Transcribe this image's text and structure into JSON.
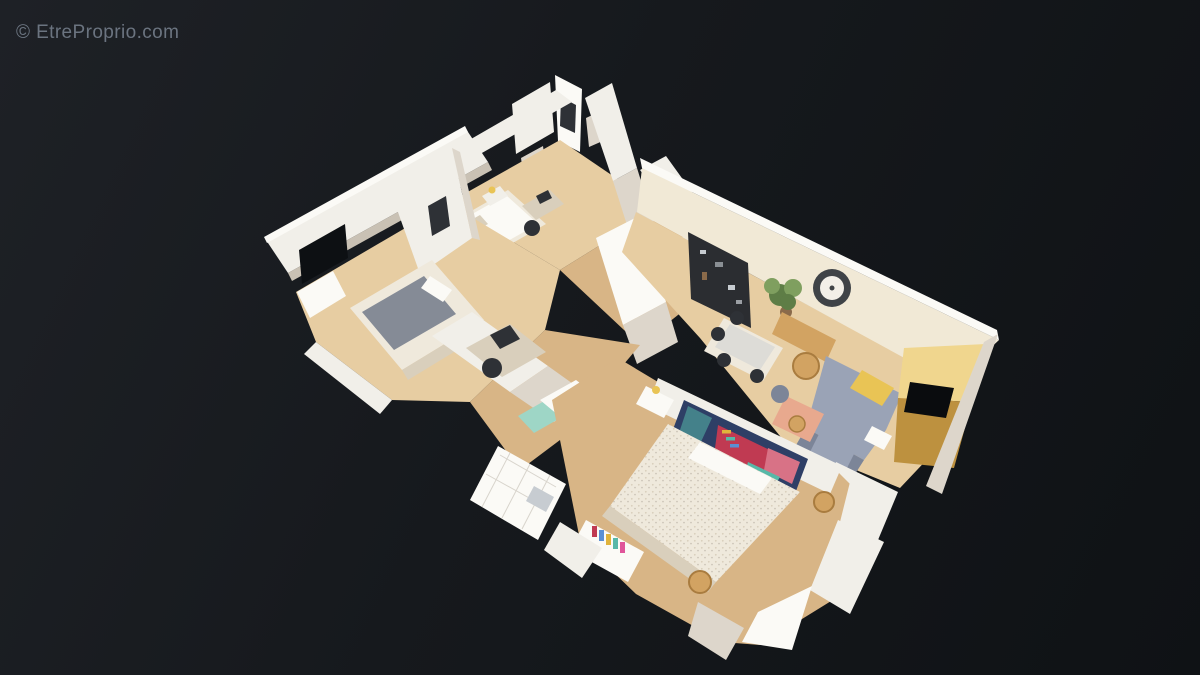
{
  "watermark": {
    "text": "© EtreProprio.com"
  },
  "scene": {
    "type": "3d-dollhouse-apartment-scan",
    "description": "Overhead cutaway 3D dollhouse scan of a furnished apartment floating on a dark background",
    "rooms": [
      {
        "name": "bedroom-1",
        "features": [
          "double bed with grey duvet",
          "two dark window openings",
          "white wardrobe",
          "radiator"
        ]
      },
      {
        "name": "bedroom-2",
        "features": [
          "single bed with white duvet",
          "nightstand lamp",
          "desk with chair"
        ]
      },
      {
        "name": "hallway",
        "features": [
          "freestanding scanned wall slabs",
          "entry door"
        ]
      },
      {
        "name": "living-dining-room",
        "features": [
          "cream back wall",
          "wall clock",
          "dark shelving unit",
          "houseplant",
          "dining table with chairs",
          "wooden console",
          "rattan stool",
          "grey corner sofa with yellow cushion",
          "salmon table",
          "backlit golden shelving with dark opening"
        ]
      },
      {
        "name": "master-bedroom",
        "features": [
          "large double bed with speckled duvet",
          "colourful wall tapestry",
          "nightstand",
          "desk with coloured books",
          "wooden stools",
          "white cut wall fragments"
        ]
      },
      {
        "name": "office-bathroom-nook",
        "features": [
          "desk with monitor and chair",
          "teal cabinet",
          "pink flowers",
          "white tiled floor"
        ]
      }
    ],
    "colors": {
      "bg-1": "#1e2126",
      "bg-2": "#16191d",
      "bg-3": "#0f1215",
      "watermark": "#6b7480",
      "wall-white": "#f1efe9",
      "wall-bright": "#fbfaf6",
      "wall-shade": "#ddd6cb",
      "wall-dim": "#c9c1b4",
      "wall-cream": "#f1e9d6",
      "floor-light": "#e7cda2",
      "floor-warm": "#d8b586",
      "window-dark": "#0d1013",
      "linen": "#efe9dc",
      "linen-shade": "#d9cfbc",
      "duvet-gray": "#858b96",
      "sofa": "#9aa3b6",
      "sofa-shade": "#7c8598",
      "cushion-yellow": "#e9c455",
      "shelf-dark": "#2b2d31",
      "gold-1": "#f0d68e",
      "gold-2": "#bd913f",
      "hole": "#0a0c0e",
      "clock": "#3f4347",
      "clock-face": "#f2efe8",
      "plant": "#5e7d46",
      "plant-light": "#7f9f5f",
      "pot": "#8a6a4a",
      "art-navy": "#2e3f66",
      "art-red": "#c03a52",
      "art-pink": "#d87286",
      "art-teal": "#57b8a8",
      "art-yellow": "#e0b33c",
      "art-blue": "#5a8fd4",
      "teal-cabinet": "#9ed6c6",
      "pink-flower": "#e0559a",
      "stool-wood": "#d2a362",
      "stool-rim": "#a97c3f",
      "salmon": "#e8a98e",
      "door-wood": "#b98a58",
      "metal": "#c7ccd1",
      "dark-item": "#2e3136"
    }
  }
}
